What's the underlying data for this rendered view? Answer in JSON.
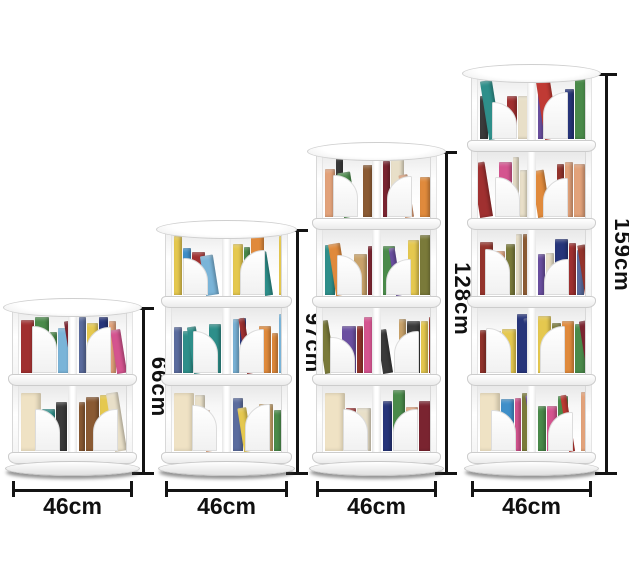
{
  "scene": {
    "background": "#ffffff",
    "dimension_line_color": "#141414",
    "dimension_text_color": "#101010",
    "shelf_white": "#ffffff",
    "shelf_edge": "#cccccc"
  },
  "shelves": [
    {
      "name": "2-tier rotating bookshelf",
      "tiers": 2,
      "height_label": "66cm",
      "width_label": "46cm"
    },
    {
      "name": "3-tier rotating bookshelf",
      "tiers": 3,
      "height_label": "97cm",
      "width_label": "46cm"
    },
    {
      "name": "4-tier rotating bookshelf",
      "tiers": 4,
      "height_label": "128cm",
      "width_label": "46cm"
    },
    {
      "name": "5-tier rotating bookshelf",
      "tiers": 5,
      "height_label": "159cm",
      "width_label": "46cm"
    }
  ],
  "book_palette": [
    "#27357a",
    "#7a2430",
    "#a03030",
    "#8a5a33",
    "#c9a36b",
    "#e8dfc8",
    "#2e8f8a",
    "#7ab4d8",
    "#3f8fc9",
    "#e08a3c",
    "#e5c84f",
    "#6a4fa0",
    "#d4548f",
    "#7a7a3a",
    "#3a3a3a",
    "#c03a34",
    "#4a8a4a",
    "#e2a27a",
    "#5b6c9e",
    "#94342c"
  ],
  "feature_book_color": "#efe2c4"
}
